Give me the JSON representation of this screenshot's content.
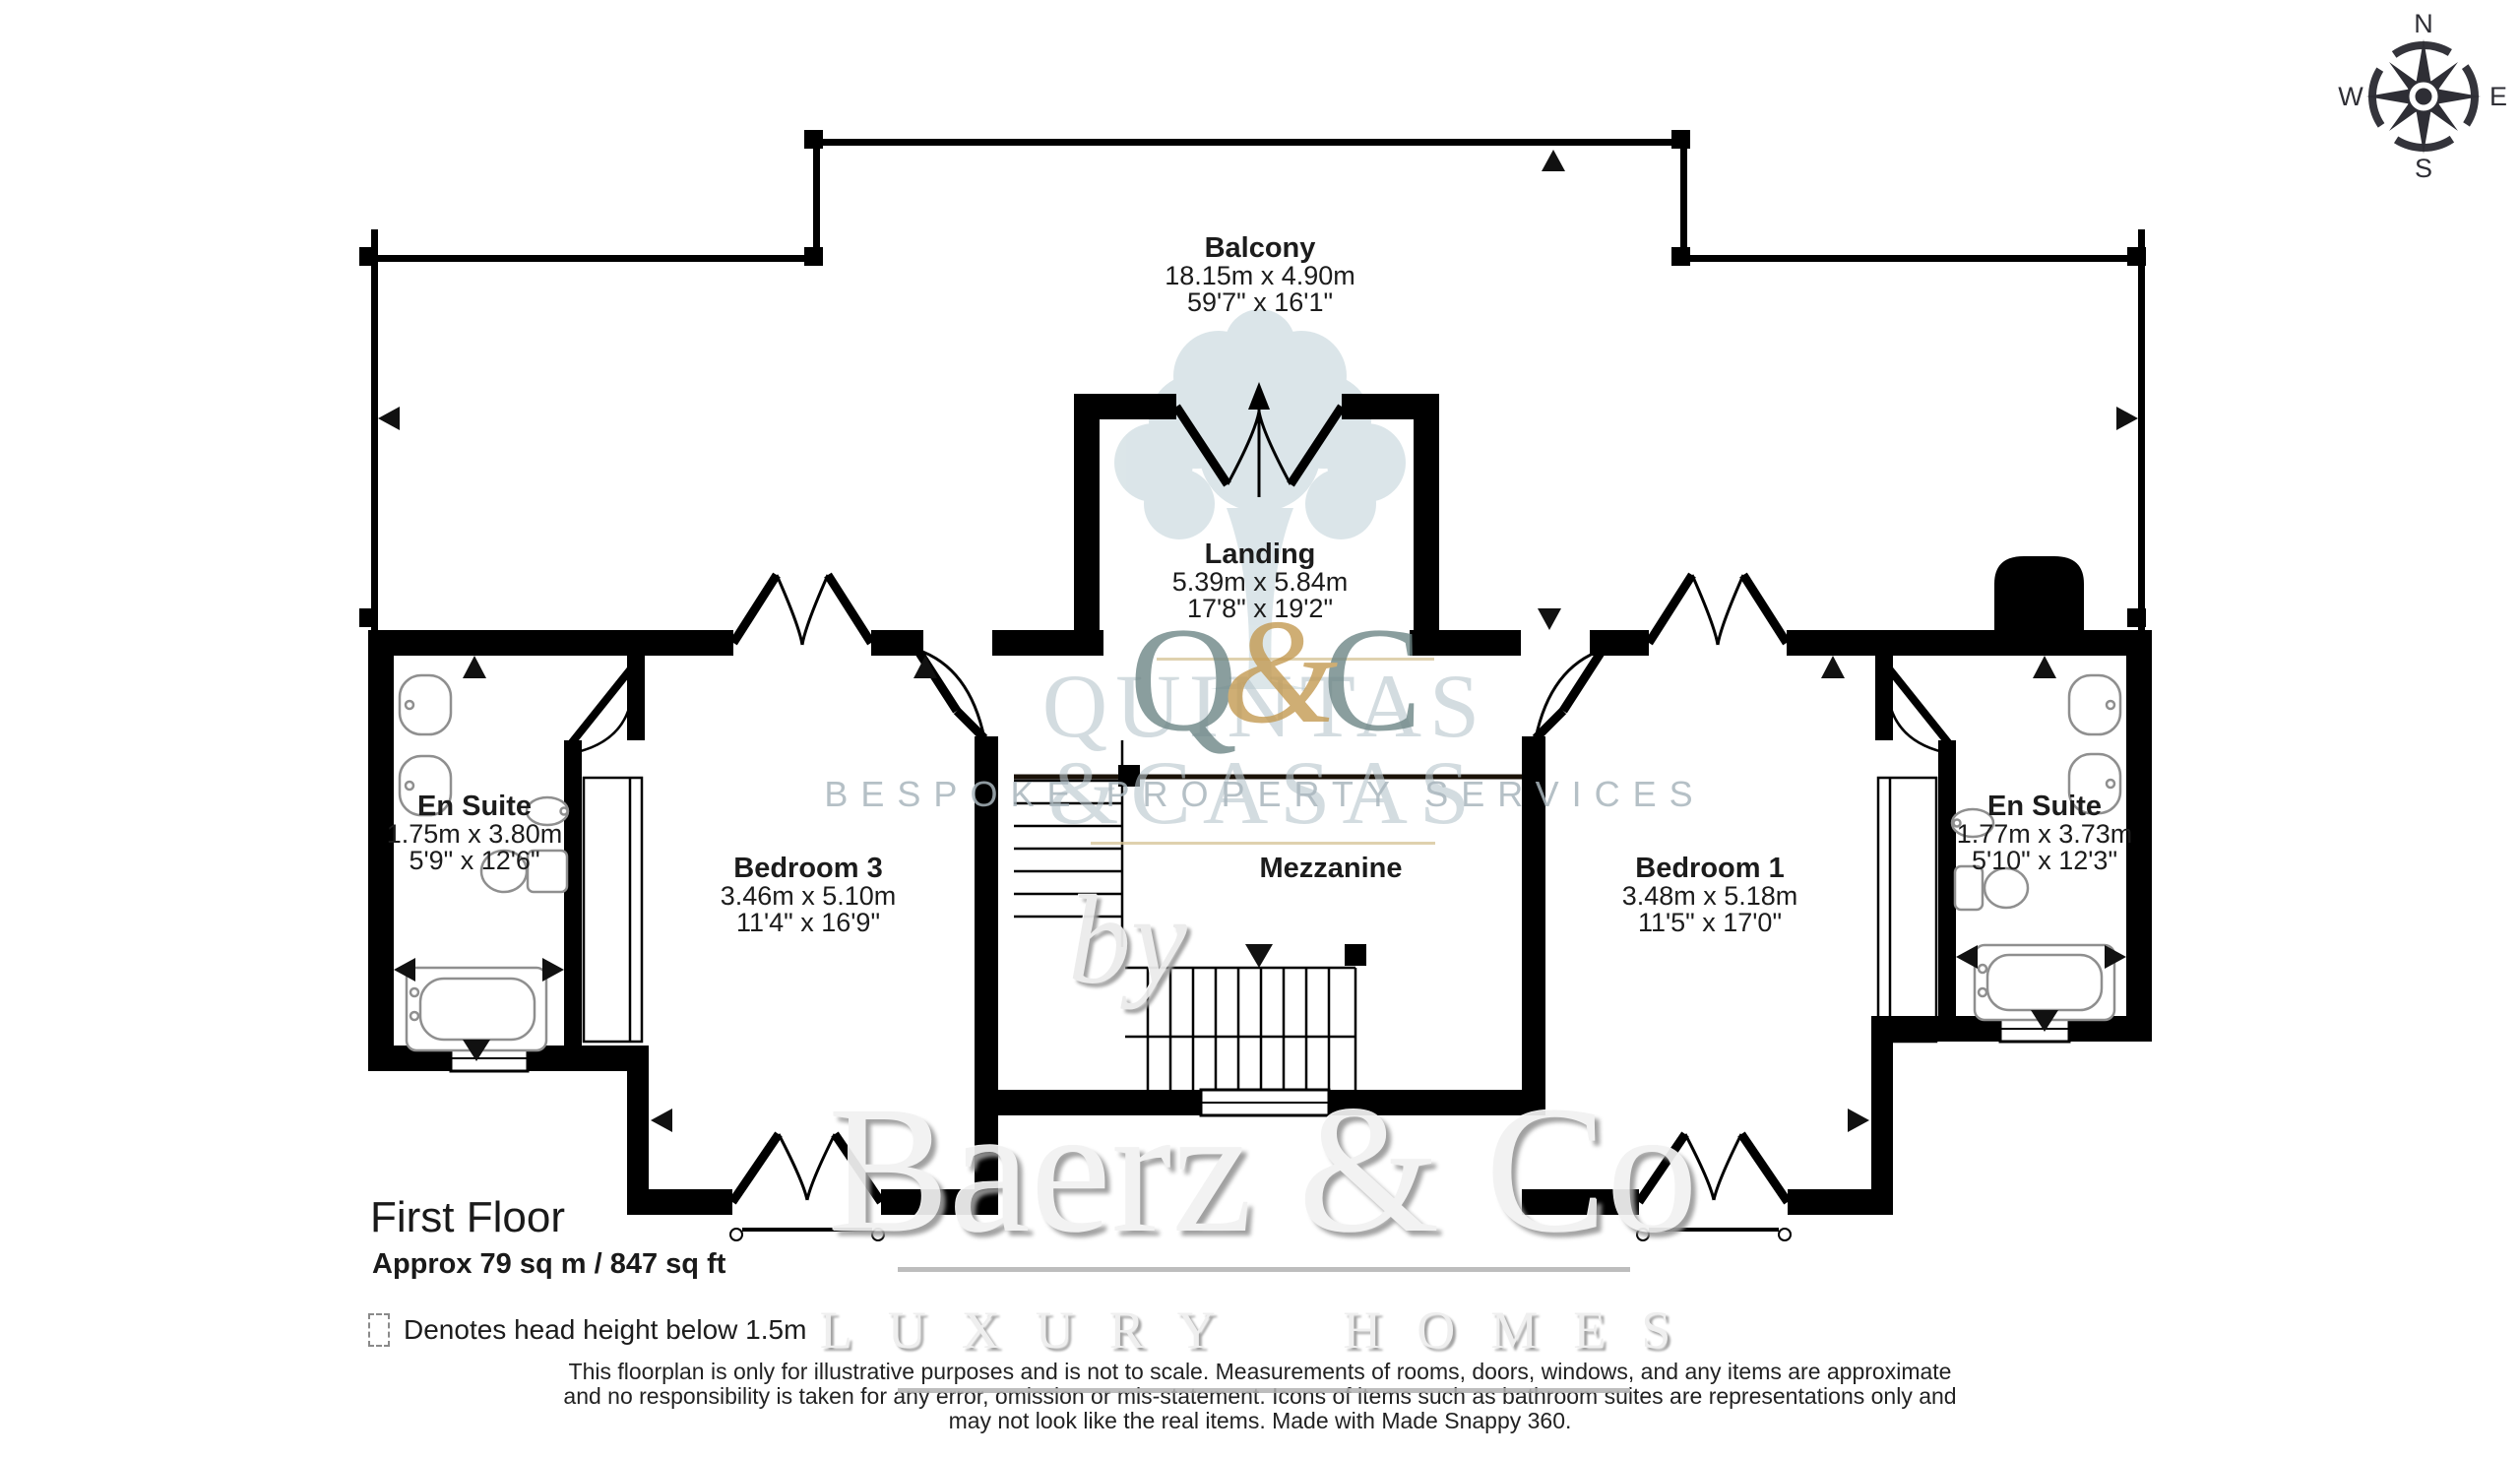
{
  "compass": {
    "n": "N",
    "e": "E",
    "s": "S",
    "w": "W"
  },
  "rooms": {
    "balcony": {
      "name": "Balcony",
      "metric": "18.15m x 4.90m",
      "imperial": "59'7\" x 16'1\""
    },
    "landing": {
      "name": "Landing",
      "metric": "5.39m x 5.84m",
      "imperial": "17'8\" x 19'2\""
    },
    "en_suite_left": {
      "name": "En Suite",
      "metric": "1.75m x 3.80m",
      "imperial": "5'9\" x 12'6\""
    },
    "bedroom_3": {
      "name": "Bedroom 3",
      "metric": "3.46m x 5.10m",
      "imperial": "11'4\" x 16'9\""
    },
    "mezzanine": {
      "name": "Mezzanine"
    },
    "bedroom_1": {
      "name": "Bedroom 1",
      "metric": "3.48m x 5.18m",
      "imperial": "11'5\" x 17'0\""
    },
    "en_suite_right": {
      "name": "En Suite",
      "metric": "1.77m x 3.73m",
      "imperial": "5'10\" x 12'3\""
    }
  },
  "floor_info": {
    "title": "First Floor",
    "area": "Approx 79 sq m / 847 sq ft"
  },
  "legend": {
    "label": "Denotes head height below 1.5m"
  },
  "watermark": {
    "q": "Q",
    "amp": "&",
    "c": "C",
    "line1": "QUINTAS",
    "line2": "&CASAS",
    "tagline": "BESPOKE PROPERTY SERVICES",
    "by": "by",
    "brand": "Baerz & Co",
    "brand_tagline": "LUXURY HOMES"
  },
  "disclaimer": {
    "line1": "This floorplan is only for illustrative purposes and is not to scale. Measurements of rooms, doors, windows, and any items are approximate",
    "line2": "and no responsibility is taken for any error, omission or mis-statement. Icons of items such as bathroom suites are representations only and",
    "line3": "may not look like the real items. Made with Made Snappy 360."
  },
  "colors": {
    "wall": "#000000",
    "fixture": "#8f8f8f",
    "watermark_teal": "#6e8787",
    "watermark_gold": "#c49a52",
    "watermark_gray": "#b7c5cc"
  }
}
